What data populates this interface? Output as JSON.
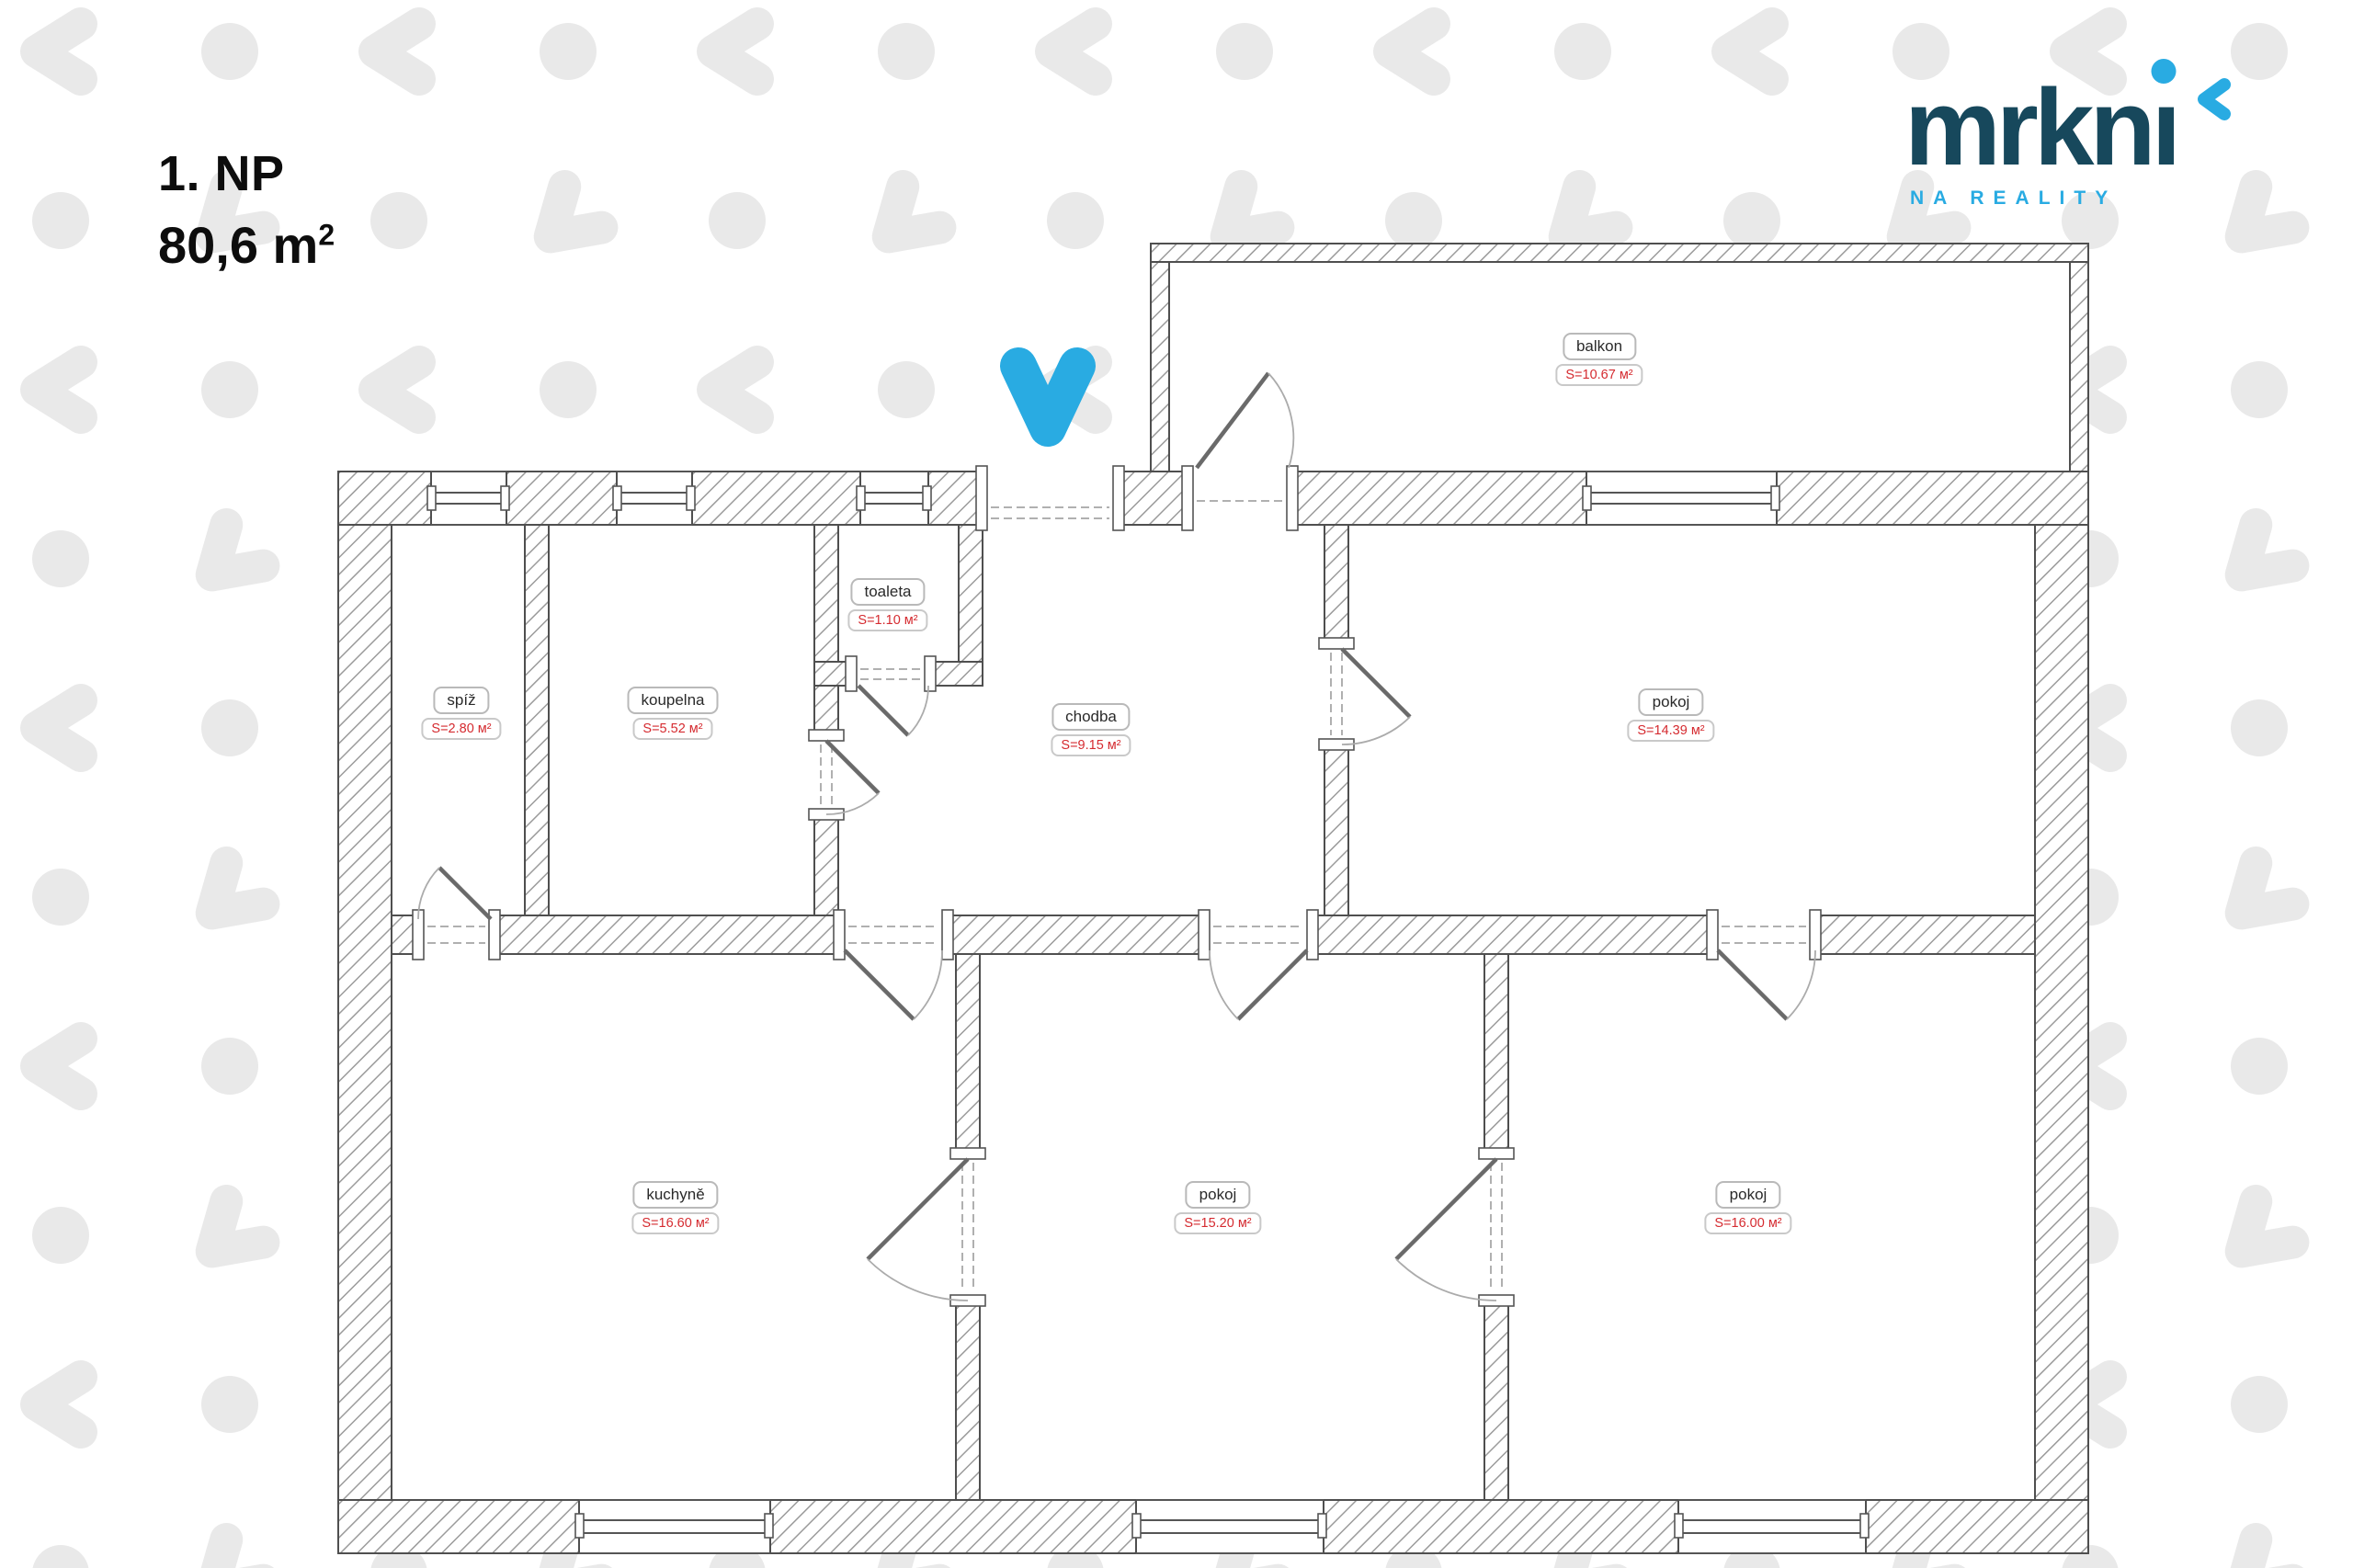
{
  "header": {
    "floor_label": "1. NP",
    "total_area": "80,6 m",
    "total_area_sup": "2"
  },
  "logo": {
    "brand_full": "mrkni",
    "brand_part1": "mrkn",
    "brand_part2": "ı",
    "tagline": "NA REALITY"
  },
  "colors": {
    "brand_dark": "#17485c",
    "brand_blue": "#29abe2",
    "area_red": "#d52b30",
    "pattern_gray": "#e9e9e9"
  },
  "plan": {
    "entrance_marker": "blue-v-entrance-arrow",
    "rooms": [
      {
        "id": "balkon",
        "name": "balkon",
        "area": "S=10.67 м²"
      },
      {
        "id": "spiz",
        "name": "spíž",
        "area": "S=2.80 м²"
      },
      {
        "id": "koupelna",
        "name": "koupelna",
        "area": "S=5.52 м²"
      },
      {
        "id": "toaleta",
        "name": "toaleta",
        "area": "S=1.10 м²"
      },
      {
        "id": "chodba",
        "name": "chodba",
        "area": "S=9.15 м²"
      },
      {
        "id": "pokoj-horni",
        "name": "pokoj",
        "area": "S=14.39 м²"
      },
      {
        "id": "kuchyne",
        "name": "kuchyně",
        "area": "S=16.60 м²"
      },
      {
        "id": "pokoj-stredni",
        "name": "pokoj",
        "area": "S=15.20 м²"
      },
      {
        "id": "pokoj-pravy",
        "name": "pokoj",
        "area": "S=16.00 м²"
      }
    ]
  }
}
